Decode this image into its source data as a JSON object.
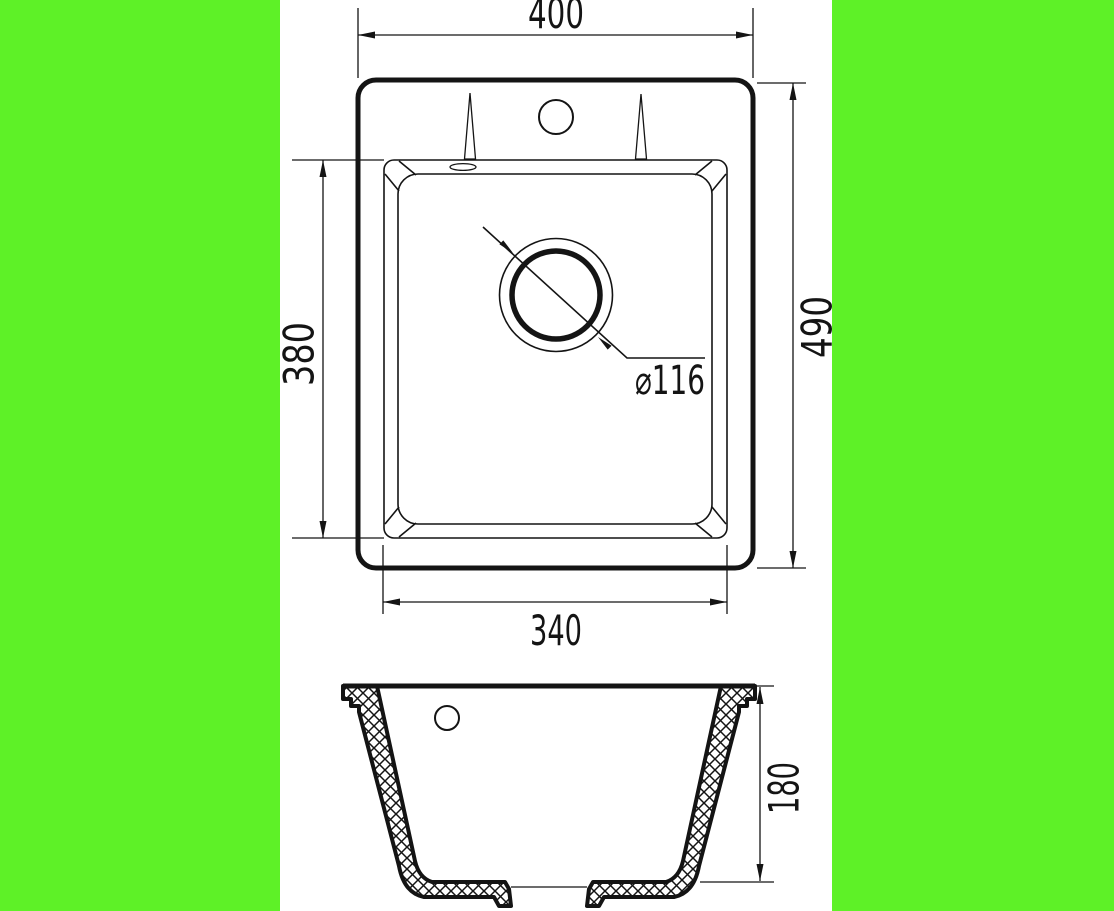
{
  "colors": {
    "background": "#5EF127",
    "paper": "#ffffff",
    "line": "#141414"
  },
  "plan_view": {
    "overall_width_label": "400",
    "overall_depth_label": "490",
    "bowl_depth_label": "380",
    "bowl_width_label": "340",
    "drain_diameter_label": "⌀116"
  },
  "section_view": {
    "bowl_height_label": "180"
  }
}
